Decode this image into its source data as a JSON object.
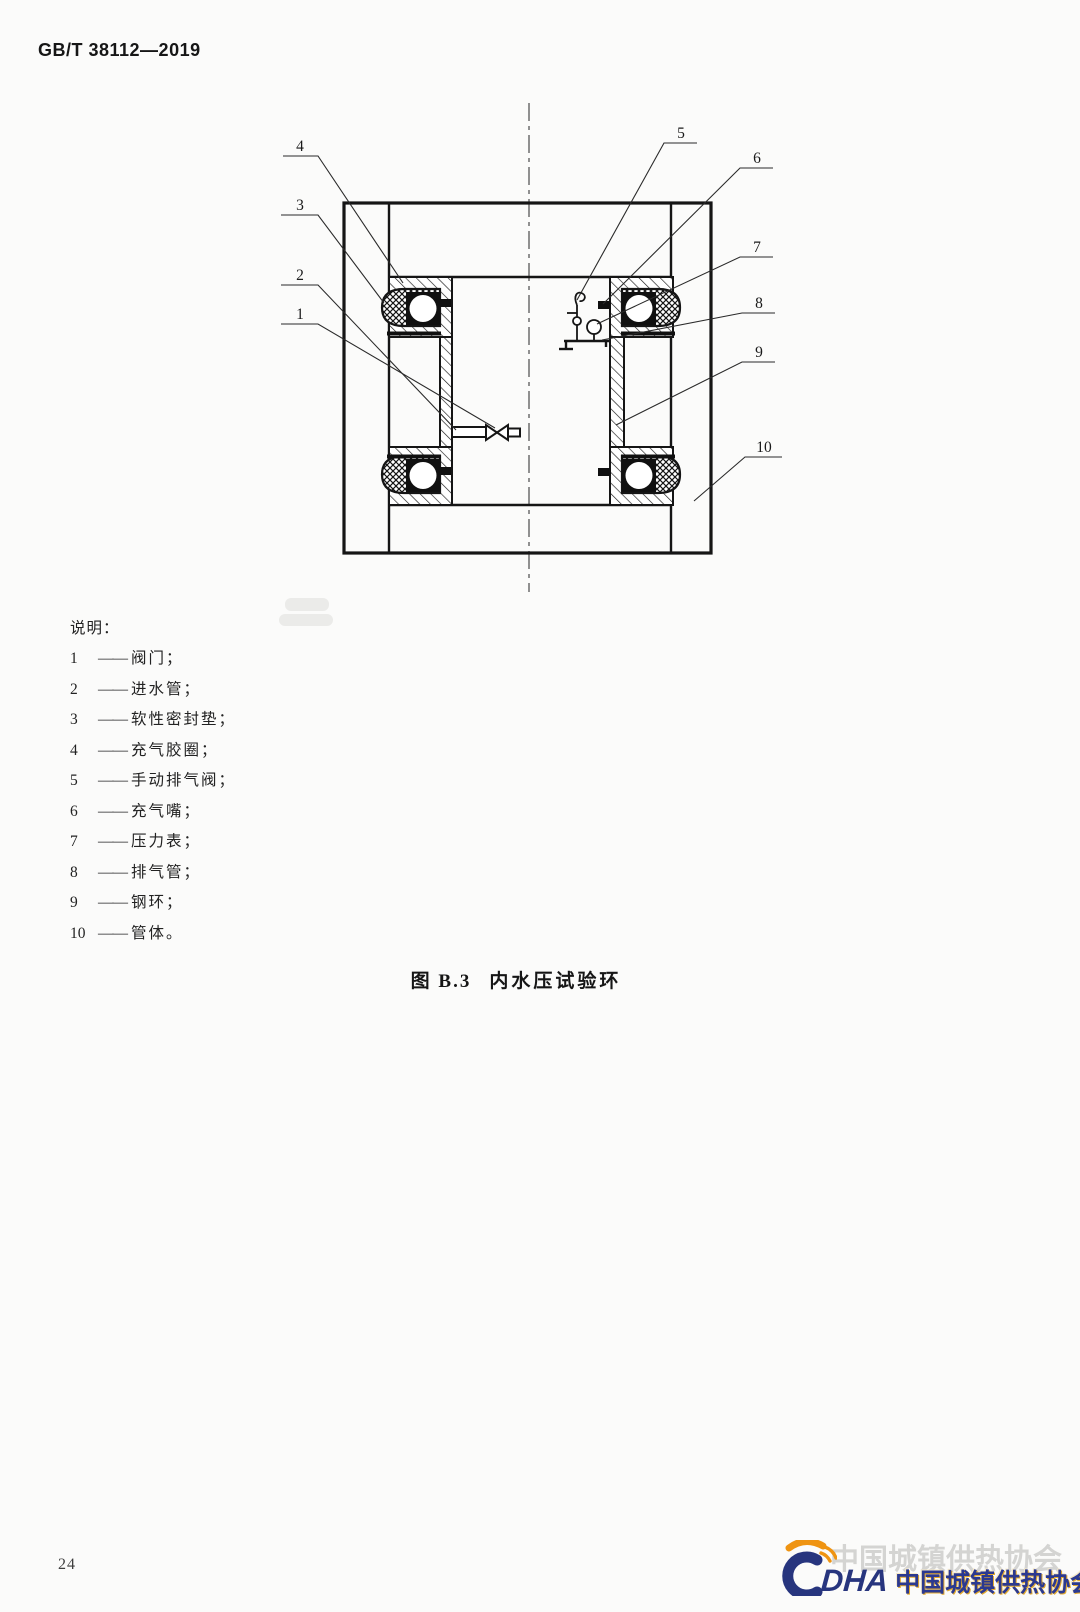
{
  "page": {
    "header": "GB/T 38112—2019",
    "page_number": "24"
  },
  "figure": {
    "caption_prefix": "图 B.3",
    "caption_title": "内水压试验环"
  },
  "legend": {
    "title": "说明：",
    "separator": "——",
    "items": [
      {
        "num": "1",
        "label": "阀门；"
      },
      {
        "num": "2",
        "label": "进水管；"
      },
      {
        "num": "3",
        "label": "软性密封垫；"
      },
      {
        "num": "4",
        "label": "充气胶圈；"
      },
      {
        "num": "5",
        "label": "手动排气阀；"
      },
      {
        "num": "6",
        "label": "充气嘴；"
      },
      {
        "num": "7",
        "label": "压力表；"
      },
      {
        "num": "8",
        "label": "排气管；"
      },
      {
        "num": "9",
        "label": "钢环；"
      },
      {
        "num": "10",
        "label": "管体。"
      }
    ]
  },
  "diagram": {
    "callouts": [
      "1",
      "2",
      "3",
      "4",
      "5",
      "6",
      "7",
      "8",
      "9",
      "10"
    ],
    "line_color": "#151515"
  },
  "logo": {
    "acronym": "DHA",
    "name": "中国城镇供热协会",
    "watermark": "中国城镇供热协会",
    "colors": {
      "blue": "#27357e",
      "orange": "#ef9412"
    }
  }
}
